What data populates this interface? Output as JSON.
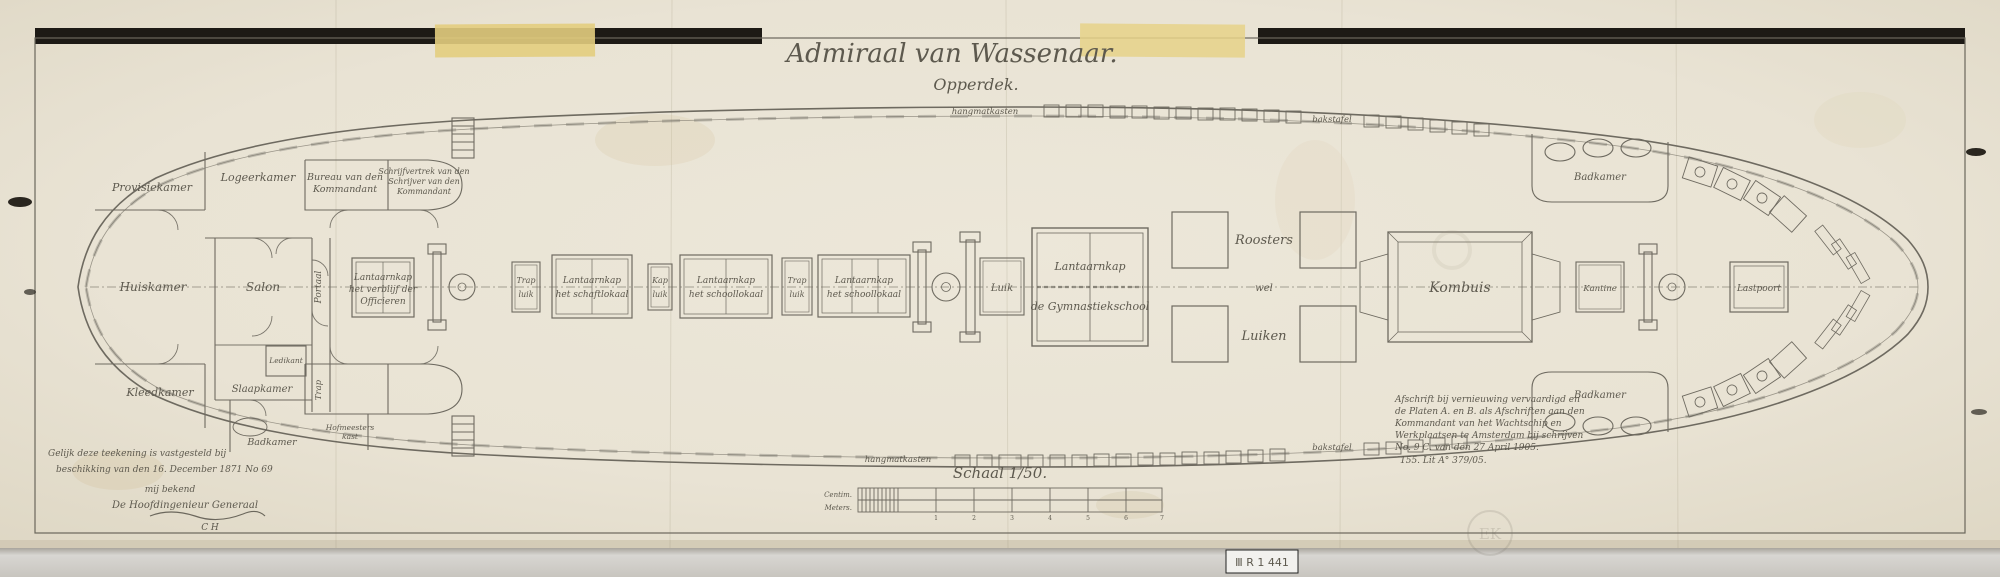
{
  "document": {
    "title": "Admiraal van Wassenaar.",
    "subtitle": "Opperdek.",
    "scale_label": "Schaal 1/50.",
    "scale_units_top": "Centim.",
    "scale_units_bottom": "Meters.",
    "stamp": "Ⅲ R 1 441",
    "watermark": "EK"
  },
  "rooms": {
    "provisiekamer": "Provisiekamer",
    "logeerkamer": "Logeerkamer",
    "bureau_l1": "Bureau van den",
    "bureau_l2": "Kommandant",
    "schrijf_l1": "Schrijfvertrek van den",
    "schrijf_l2": "Schrijver van den",
    "schrijf_l3": "Kommandant",
    "huiskamer": "Huiskamer",
    "salon": "Salon",
    "portaal": "Portaal",
    "kleedkamer": "Kleedkamer",
    "slaapkamer": "Slaapkamer",
    "ledikant": "Ledikant",
    "badkamer": "Badkamer",
    "trap": "Trap",
    "hofmeesters_l1": "Hofmeesters",
    "hofmeesters_l2": "kast",
    "kombuis": "Kombuis",
    "kantine": "Kantine",
    "lastpoort": "Lastpoort",
    "badkamer_top": "Badkamer",
    "badkamer_bottom": "Badkamer"
  },
  "deck": {
    "skylight_off_l1": "Lantaarnkap",
    "skylight_off_l2": "het verblijf der",
    "skylight_off_l3": "Officieren",
    "sky1_l1": "Lantaarnkap",
    "sky1_l2": "het schaftlokaal",
    "sky2_l1": "Lantaarnkap",
    "sky2_l2": "het schoollokaal",
    "sky3_l1": "Lantaarnkap",
    "sky3_l2": "het schoollokaal",
    "gym_l1": "Lantaarnkap",
    "gym_l2": "de Gymnastiekschool",
    "trapluik1_l1": "Trap",
    "trapluik1_l2": "luik",
    "kapluik_l1": "Kap",
    "kapluik_l2": "luik",
    "trapluik2_l1": "Trap",
    "trapluik2_l2": "luik",
    "luik": "Luik",
    "roosters": "Roosters",
    "wel": "wel",
    "luiken": "Luiken",
    "hangmat_top": "hangmatkasten",
    "hangmat_bottom": "hangmatkasten",
    "bakstafel_top": "bakstafel",
    "bakstafel_bottom": "bakstafel"
  },
  "notes_left": {
    "l1": "Gelijk deze teekening is vastgesteld bij",
    "l2": "beschikking van den 16. December 1871 No 69",
    "l3": "mij bekend",
    "l4": "De Hoofdingenieur Generaal",
    "l5": "C H"
  },
  "notes_right": {
    "l1": "Afschrift bij vernieuwing vervaardigd en",
    "l2": "de Platen A. en B. als Afschriften aan den",
    "l3": "Kommandant van het Wachtschip en",
    "l4": "Werkplaatsen te Amsterdam bij schrijven",
    "l5": "No. 9 C. van den 27 April 1905.",
    "l6": "155. Lit A° 379/05."
  },
  "scale_numbers": [
    "1",
    "2",
    "3",
    "4",
    "5",
    "6",
    "7"
  ]
}
